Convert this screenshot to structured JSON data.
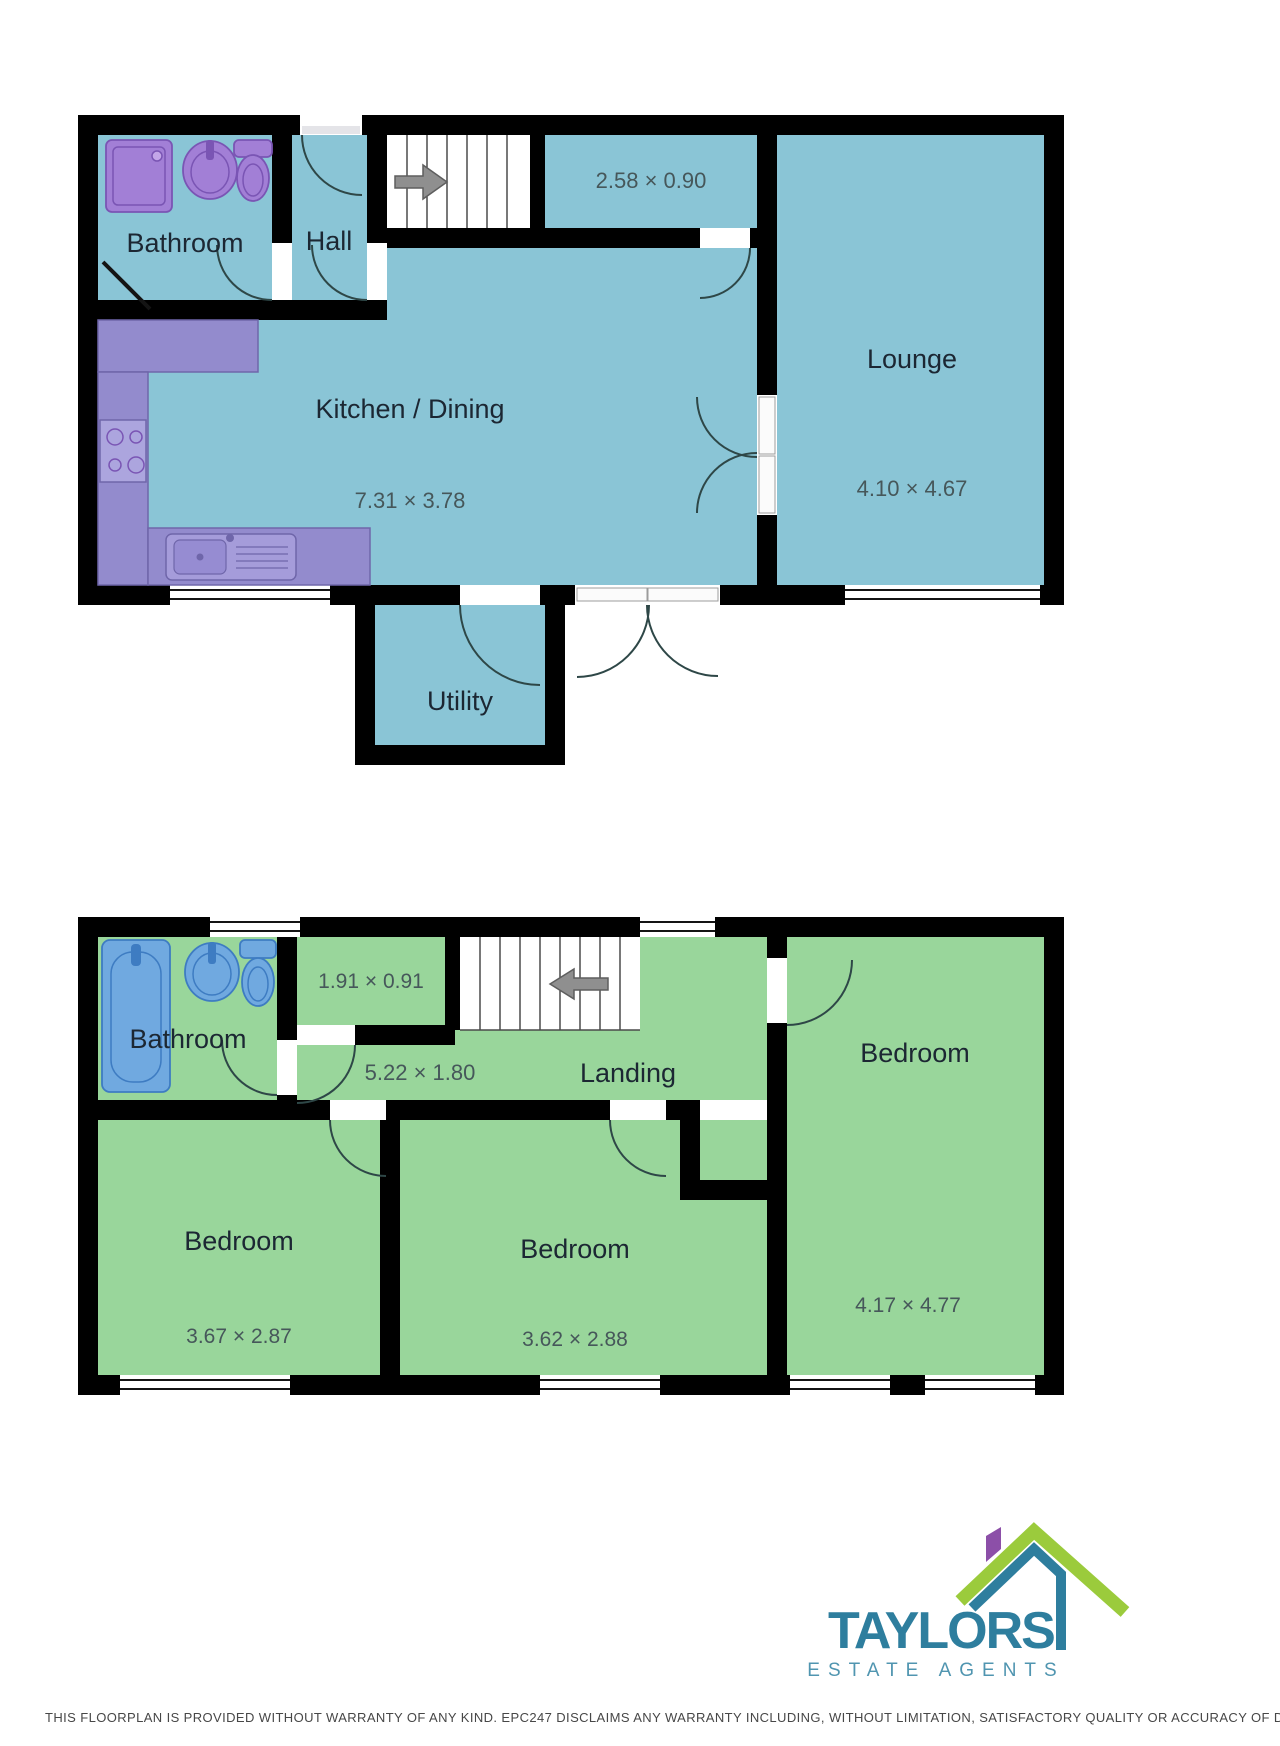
{
  "ground": {
    "bathroom_label": "Bathroom",
    "hall_label": "Hall",
    "passage_dims": "2.58 × 0.90",
    "kitchen_label": "Kitchen / Dining",
    "kitchen_dims": "7.31 × 3.78",
    "lounge_label": "Lounge",
    "lounge_dims": "4.10 × 4.67",
    "utility_label": "Utility"
  },
  "first": {
    "bathroom_label": "Bathroom",
    "cupboard_dims": "1.91 × 0.91",
    "landing_label": "Landing",
    "landing_dims": "5.22 × 1.80",
    "bedroom1_label": "Bedroom",
    "bedroom1_dims": "3.67 × 2.87",
    "bedroom2_label": "Bedroom",
    "bedroom2_dims": "3.62 × 2.88",
    "bedroom3_label": "Bedroom",
    "bedroom3_dims": "4.17 × 4.77"
  },
  "branding": {
    "name": "TAYLORS",
    "tagline": "ESTATE AGENTS",
    "teal": "#2E7E9E",
    "green": "#9BCB3C",
    "purple": "#8C4FA8"
  },
  "disclaimer_text": "THIS FLOORPLAN IS PROVIDED WITHOUT WARRANTY OF ANY KIND. EPC247 DISCLAIMS ANY WARRANTY INCLUDING, WITHOUT LIMITATION, SATISFACTORY QUALITY OR ACCURACY OF DIMENSIONS.",
  "colors": {
    "ground_floor_fill": "#8AC5D6",
    "first_floor_fill": "#99D69B",
    "wall": "#000000",
    "kitchen_counter": "#938BCD",
    "fixture_purple": "#A27FD6",
    "fixture_blue": "#70A9E0"
  }
}
